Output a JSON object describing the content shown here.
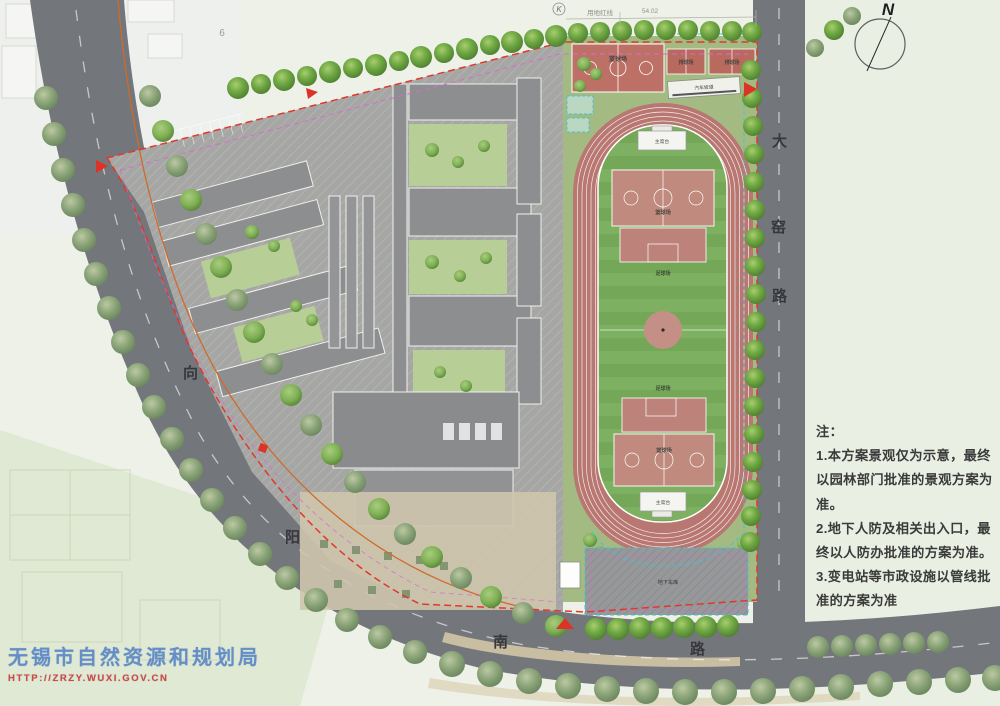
{
  "map": {
    "north_label": "N",
    "k_marker": "K",
    "top_dims": {
      "red_line_label": "用地红线",
      "length": "54.02",
      "six": "6"
    },
    "roads": {
      "xiangyang_nanlu": {
        "chars": [
          "向",
          "阳",
          "南",
          "路"
        ]
      },
      "dayao_lu": {
        "chars": [
          "大",
          "窑",
          "路"
        ]
      }
    },
    "sports": {
      "basketball_court_top": "篮球场",
      "volleyball_court_a": "排球场",
      "volleyball_court_b": "排球场",
      "car_ramp": "汽车坡道",
      "stand_north": "主席台",
      "stand_south": "主席台",
      "infield_basketball_north": "篮球场",
      "infield_basketball_south": "篮球场",
      "soccer_field_north": "足球场",
      "soccer_field_south": "足球场",
      "underground_garage": "地下车库"
    }
  },
  "notes": {
    "heading": "注：",
    "lines": [
      "1.本方案景观仅为示意，最终",
      "以园林部门批准的景观方案为",
      "准。",
      "2.地下人防及相关出入口，最",
      "终以人防办批准的方案为准。",
      "3.变电站等市政设施以管线批",
      "准的方案为准"
    ]
  },
  "watermark": {
    "agency": "无锡市自然资源和规划局",
    "url": "HTTP://ZRZY.WUXI.GOV.CN"
  },
  "colors": {
    "track": "#b87770",
    "infield_green": "#74a757",
    "court_pink": "#c08a7e",
    "road_gray": "#73767b",
    "boundary_red": "#e2382c",
    "tree_green": "#5f9838",
    "watermark_blue": "#5b86c6",
    "watermark_red": "#d6453c"
  }
}
